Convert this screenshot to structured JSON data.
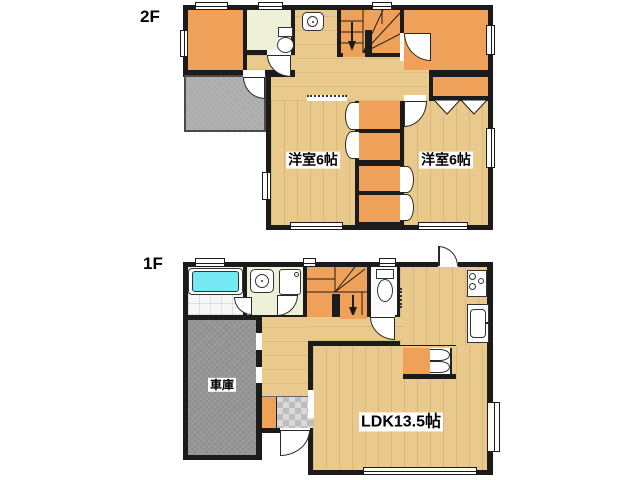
{
  "floor2": {
    "name": "2F",
    "rooms": [
      {
        "id": "western-room-left",
        "label": "洋室6帖"
      },
      {
        "id": "western-room-right",
        "label": "洋室6帖"
      }
    ]
  },
  "floor1": {
    "name": "1F",
    "rooms": [
      {
        "id": "ldk",
        "label": "LDK13.5帖"
      },
      {
        "id": "garage",
        "label": "車庫"
      }
    ]
  },
  "colors": {
    "wall": "#1b1b1b",
    "wood": "#e9c98c",
    "orange": "#f0a159",
    "cream": "#eef0d8",
    "gray_balcony": "#ababab",
    "gray_garage": "#969696",
    "entrance_tile": "#d9d9d9",
    "bathtub": "#74e9f4"
  }
}
